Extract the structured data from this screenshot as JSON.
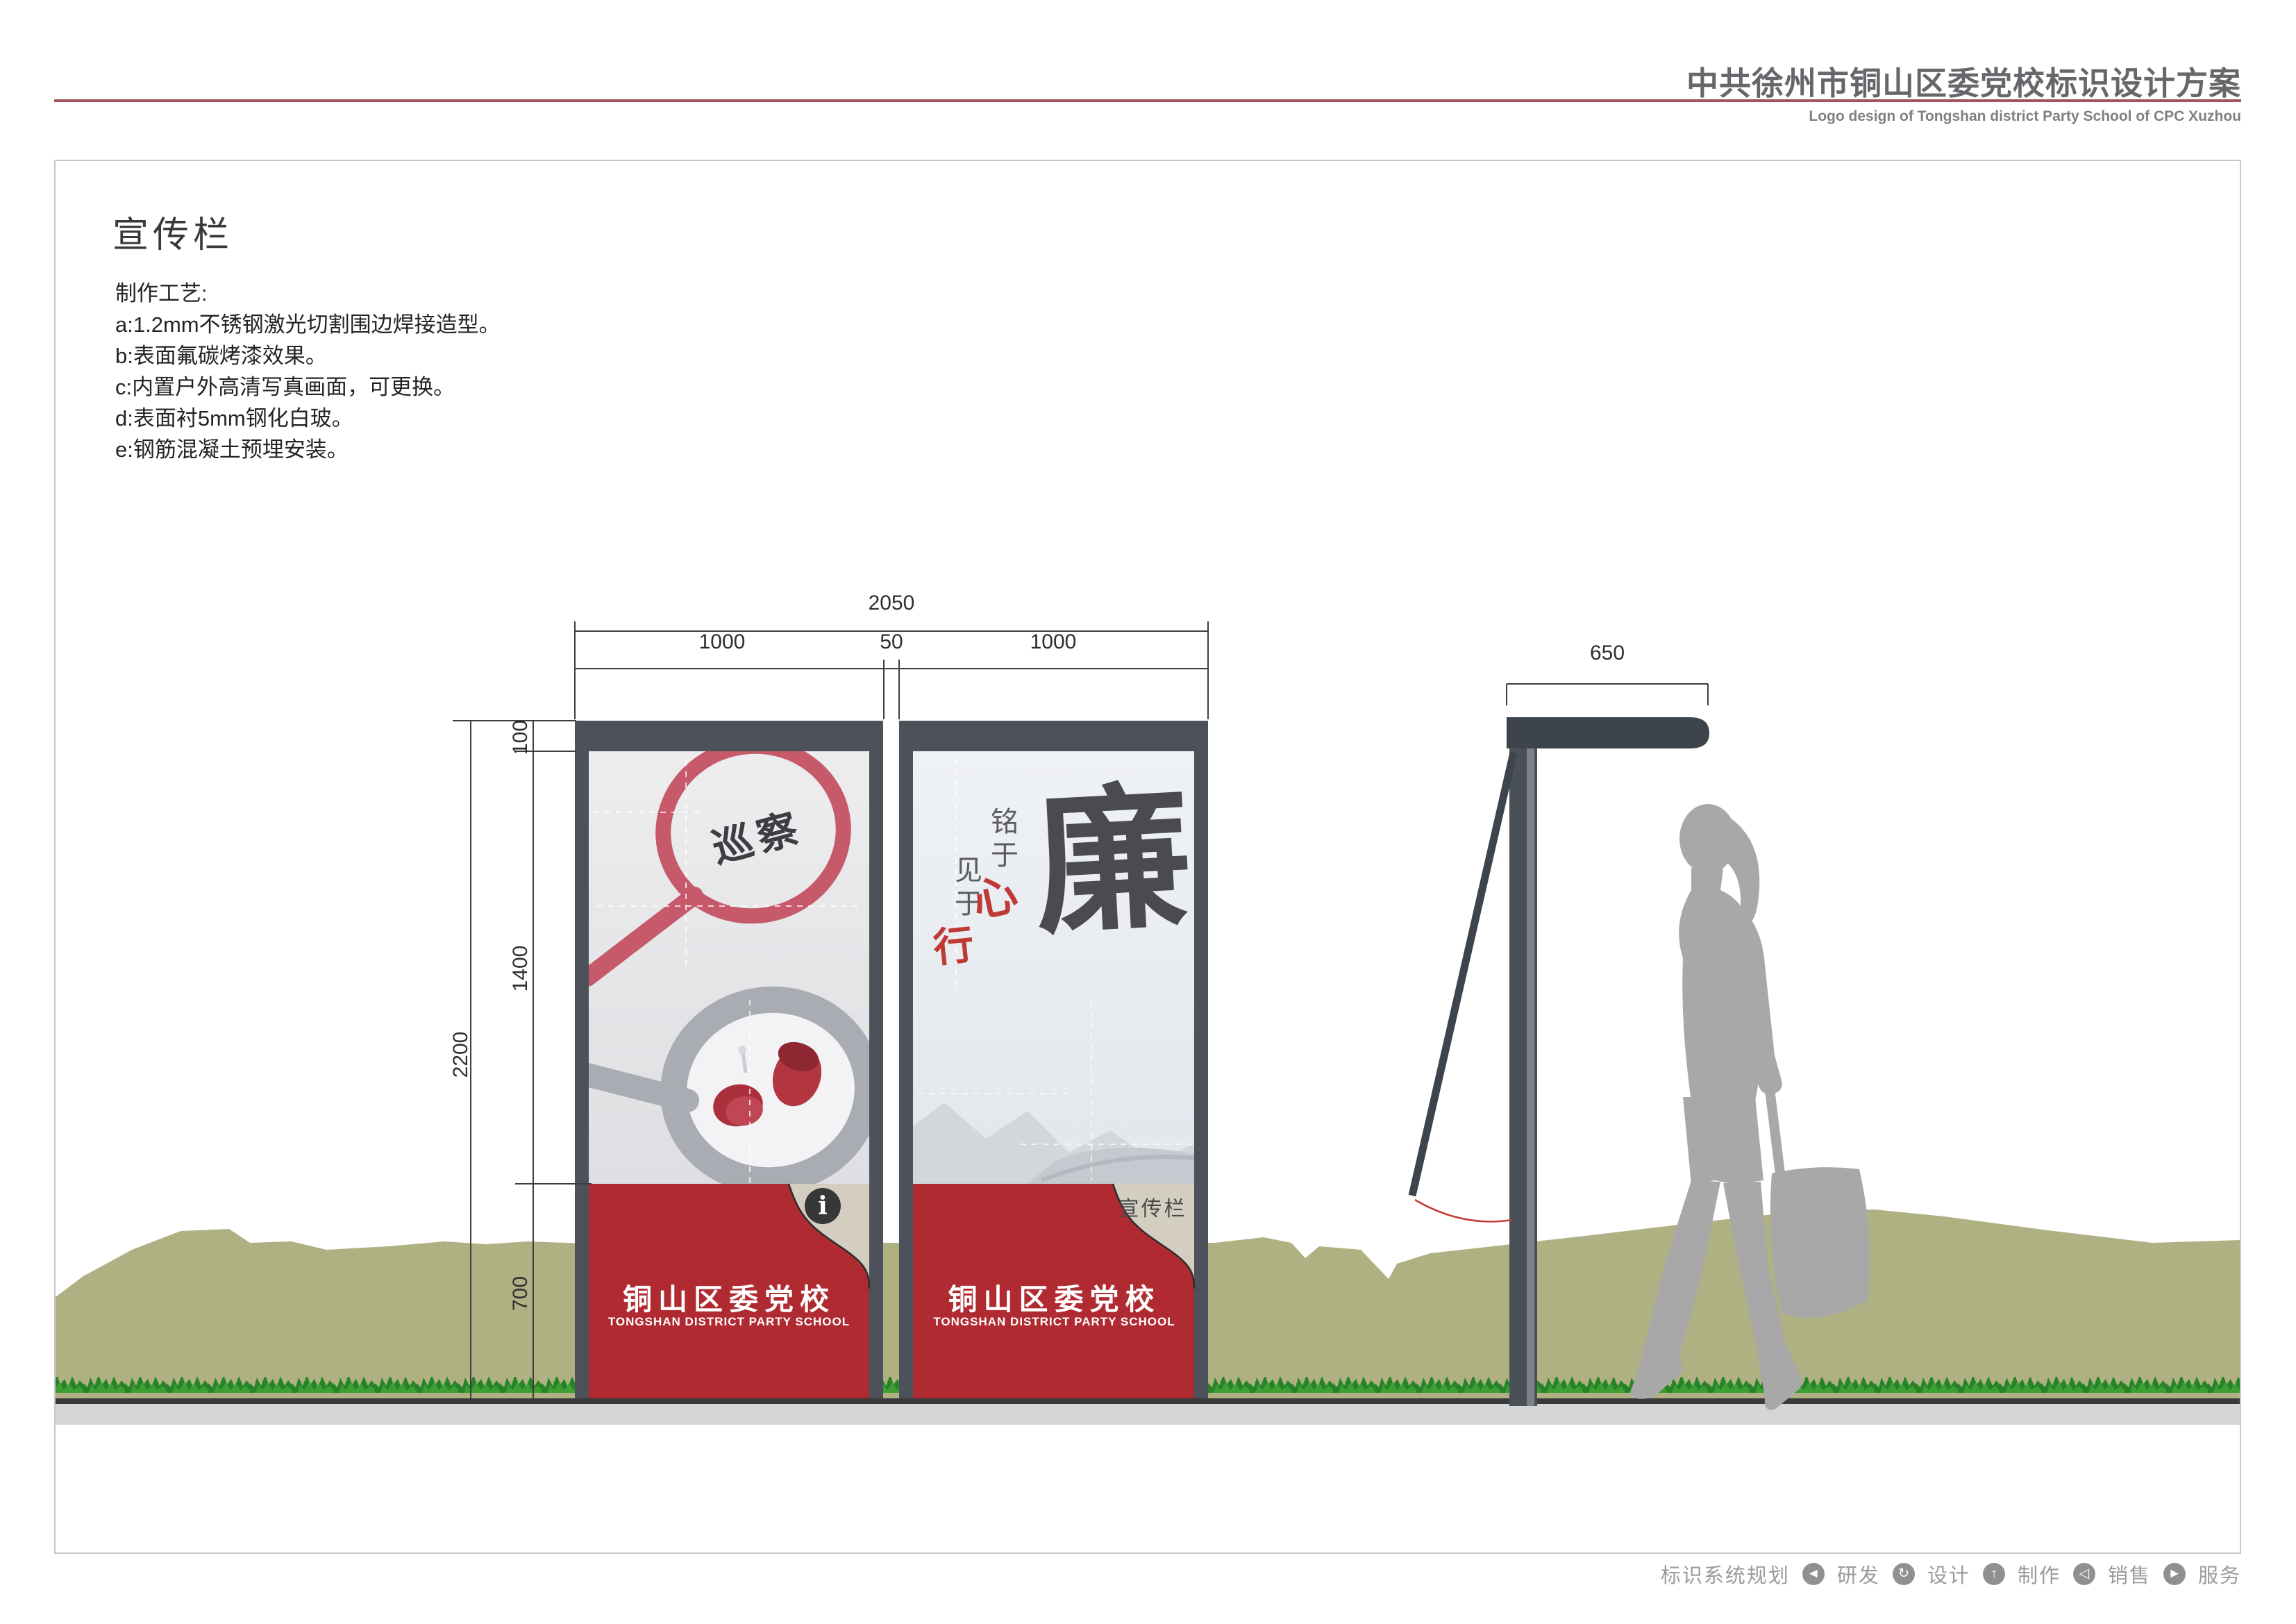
{
  "header": {
    "title": "中共徐州市铜山区委党校标识设计方案",
    "subtitle": "Logo design of Tongshan district Party School of CPC Xuzhou"
  },
  "section": {
    "title": "宣传栏"
  },
  "process": {
    "heading": "制作工艺:",
    "items": [
      "a:1.2mm不锈钢激光切割围边焊接造型。",
      "b:表面氟碳烤漆效果。",
      "c:内置户外高清写真画面，可更换。",
      "d:表面衬5mm钢化白玻。",
      "e:钢筋混凝土预埋安装。"
    ]
  },
  "dimensions": {
    "front": {
      "total_width": "2050",
      "panel_left": "1000",
      "gap": "50",
      "panel_right": "1000",
      "cap_height": "100",
      "poster_height": "1400",
      "base_height": "700",
      "total_height": "2200"
    },
    "side": {
      "depth": "650"
    }
  },
  "panels": {
    "left": {
      "poster_text": "巡察",
      "base_cn": "铜山区委党校",
      "base_en": "TONGSHAN DISTRICT PARTY SCHOOL",
      "info_glyph": "i"
    },
    "right": {
      "poster_chars": {
        "ming_yu": "铭于",
        "jian_yu": "见于",
        "xin": "心",
        "xing": "行",
        "lian": "廉"
      },
      "base_cn": "铜山区委党校",
      "base_en": "TONGSHAN DISTRICT PARTY SCHOOL",
      "corner_label": "宣传栏"
    }
  },
  "footer": {
    "labels": [
      "标识系统规划",
      "研发",
      "设计",
      "制作",
      "销售",
      "服务"
    ],
    "icons": [
      "◄",
      "↻",
      "↑",
      "◁",
      "►"
    ]
  },
  "colors": {
    "accent_red": "#b02b31",
    "header_rule": "#a5535e",
    "panel_dark": "#4c515a",
    "corner_beige": "#d4cec1",
    "landscape_olive": "#b0b183",
    "silhouette_gray": "#a8a8a8"
  }
}
